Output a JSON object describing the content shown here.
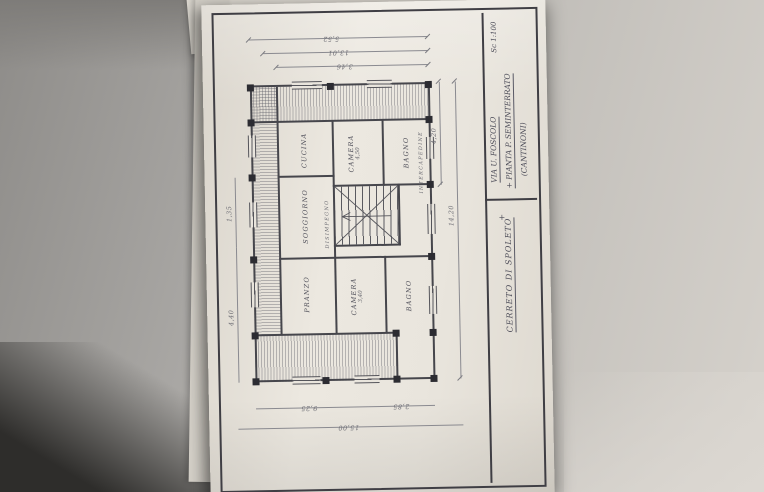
{
  "colors": {
    "paper": "#e9e5dd",
    "ink": "#46464c",
    "pencil": "#6f6f76",
    "background": "#a6a4a1"
  },
  "title_block": {
    "street": "VIA U. FOSCOLO",
    "plan_title": "+ PIANTA P. SEMINTERRATO",
    "plan_subtitle": "(CANTINONI)",
    "scale": "Sc 1:100",
    "location": "CERRETO DI SPOLETO",
    "location_mark": "+"
  },
  "rooms": [
    {
      "name": "PRANZO"
    },
    {
      "name": "SOGGIORNO"
    },
    {
      "name": "CUCINA"
    },
    {
      "name": "CAMERA",
      "area": "3,40"
    },
    {
      "name": "BAGNO"
    },
    {
      "name": "CAMERA",
      "area": "4,50"
    },
    {
      "name": "BAGNO"
    }
  ],
  "annotations": {
    "intercapedine": "INTERCAPEDINE",
    "disimpegno": "DISIMPEGNO"
  },
  "dimensions": {
    "top_left": "4,40",
    "top_mid": "1,35",
    "right_outer": "5,52",
    "right_mid": "13,01",
    "right_inner": "3,46",
    "left_total": "15,00",
    "left_upper": "9,25",
    "left_lower": "2,85",
    "bottom_total": "14,20",
    "bottom_right": "4,20"
  }
}
